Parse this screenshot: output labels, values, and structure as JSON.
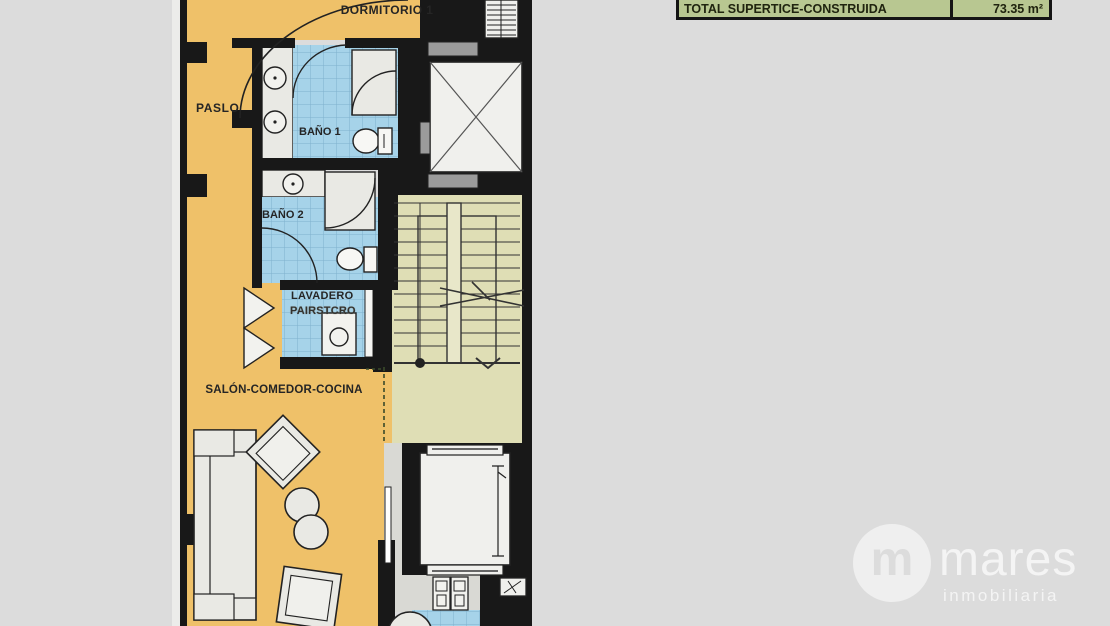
{
  "canvas": {
    "width": 1110,
    "height": 626,
    "bg": "#dcdcdc"
  },
  "summary_table": {
    "label": "TOTAL SUPERTICE-CONSTRUIDA",
    "value": "73.35 m²",
    "bg": "#b8c791",
    "border": "#151515"
  },
  "floorplan": {
    "rooms": {
      "dormitorio1": "DORMITORIO 1",
      "pasillo": "PASLO",
      "bano1": "BAÑO 1",
      "bano2": "BAÑO 2",
      "lavadero": "LAVADERO",
      "lavadero_sub": "PAIRSTCRO",
      "salon": "SALÓN-COMEDOR-COCINA"
    },
    "colors": {
      "floor_orange": "#efc169",
      "tile_blue": "#a6d3e9",
      "tile_grid_blue": "#5f93b5",
      "stairs_green": "#dfdeb5",
      "wall_black": "#181818",
      "furniture_gray": "#e9e9e4",
      "floor_gray": "#d9d9d4",
      "band_gray": "#9b9b9b",
      "lightwell_white": "#f0f0ed"
    },
    "symbols": [
      "stairs-icon",
      "stairs-direction-arrow-icon",
      "stairs-break-line-icon",
      "elevator-icon",
      "lightwell-x-icon",
      "ladder-icon",
      "sink-icon",
      "toilet-icon",
      "shower-icon",
      "washer-icon",
      "kitchen-sink-icon",
      "shaft-symbol-icon",
      "sofa-icon",
      "armchair-icon",
      "round-table-icon",
      "radiator-icon",
      "door-arc-icon",
      "folding-door-icon"
    ]
  },
  "watermark": {
    "logo_letter": "m",
    "brand": "mares",
    "tagline": "inmobiliaria"
  }
}
